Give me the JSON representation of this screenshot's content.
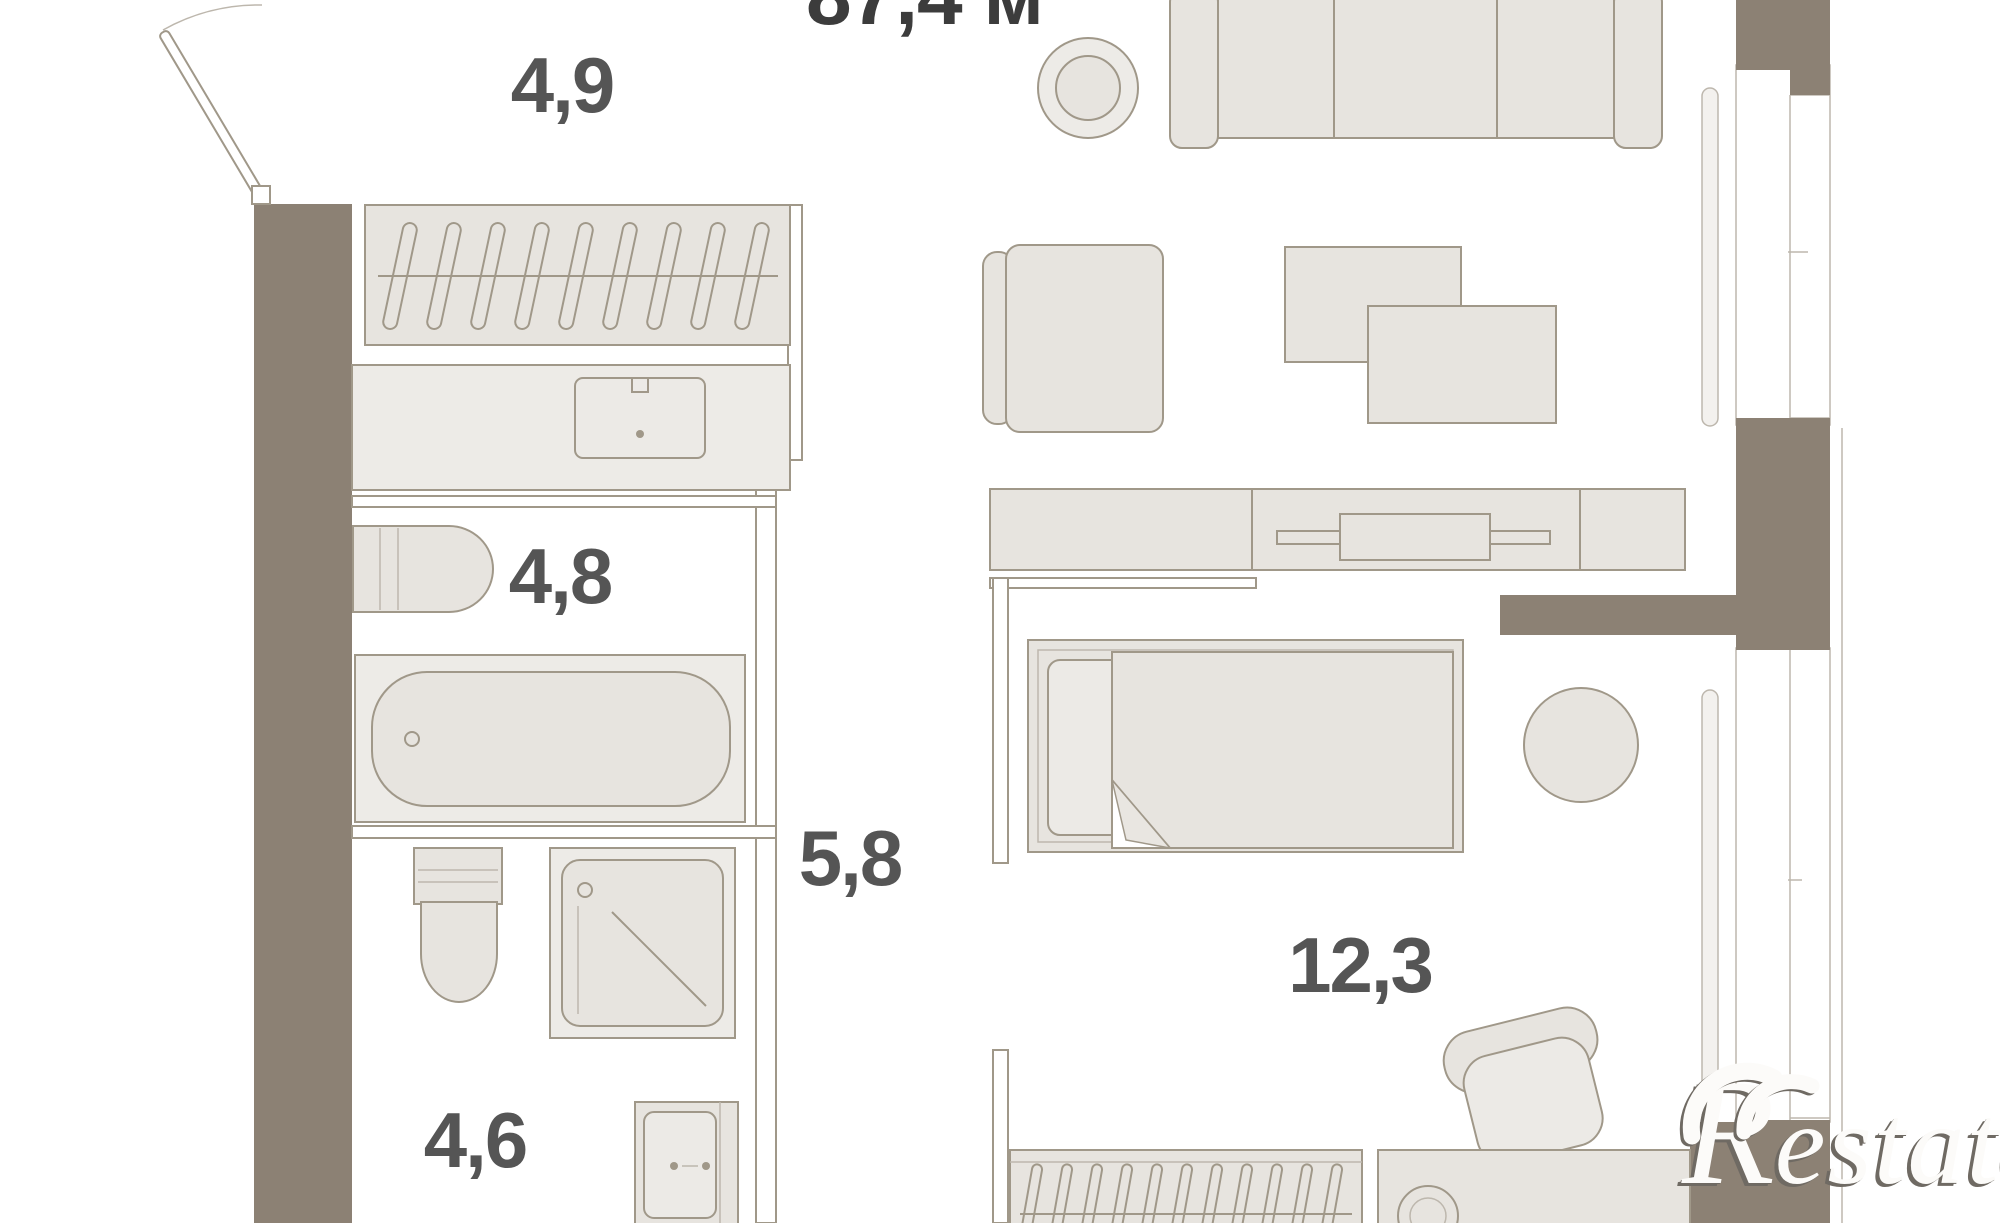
{
  "plan": {
    "total_area_label": "87,4 м",
    "rooms": [
      {
        "name": "hallway",
        "area": "4,9"
      },
      {
        "name": "bathroom",
        "area": "4,8"
      },
      {
        "name": "corridor",
        "area": "5,8"
      },
      {
        "name": "wc",
        "area": "4,6"
      },
      {
        "name": "bedroom",
        "area": "12,3"
      }
    ],
    "watermark": {
      "logo_letter": "R",
      "text": "estate"
    },
    "colors": {
      "wall": "#8c8174",
      "furniture_fill": "#e7e4df",
      "furniture_fill_light": "#edebe7",
      "stroke": "#a09889",
      "stroke_light": "#bdb7ad",
      "label_text": "#555555",
      "total_text": "#3c3c3c",
      "watermark_shadow": "#6f6a63"
    },
    "furniture_icons": [
      "entry-door",
      "wardrobe-hangers",
      "vanity-sink",
      "washing-machine",
      "bathtub",
      "toilet",
      "shower-cabin",
      "washbasin",
      "sofa",
      "plant",
      "armchair",
      "coffee-table",
      "tv-sideboard",
      "bed",
      "round-side-table",
      "desk-chair",
      "desk",
      "radiator",
      "window"
    ]
  }
}
